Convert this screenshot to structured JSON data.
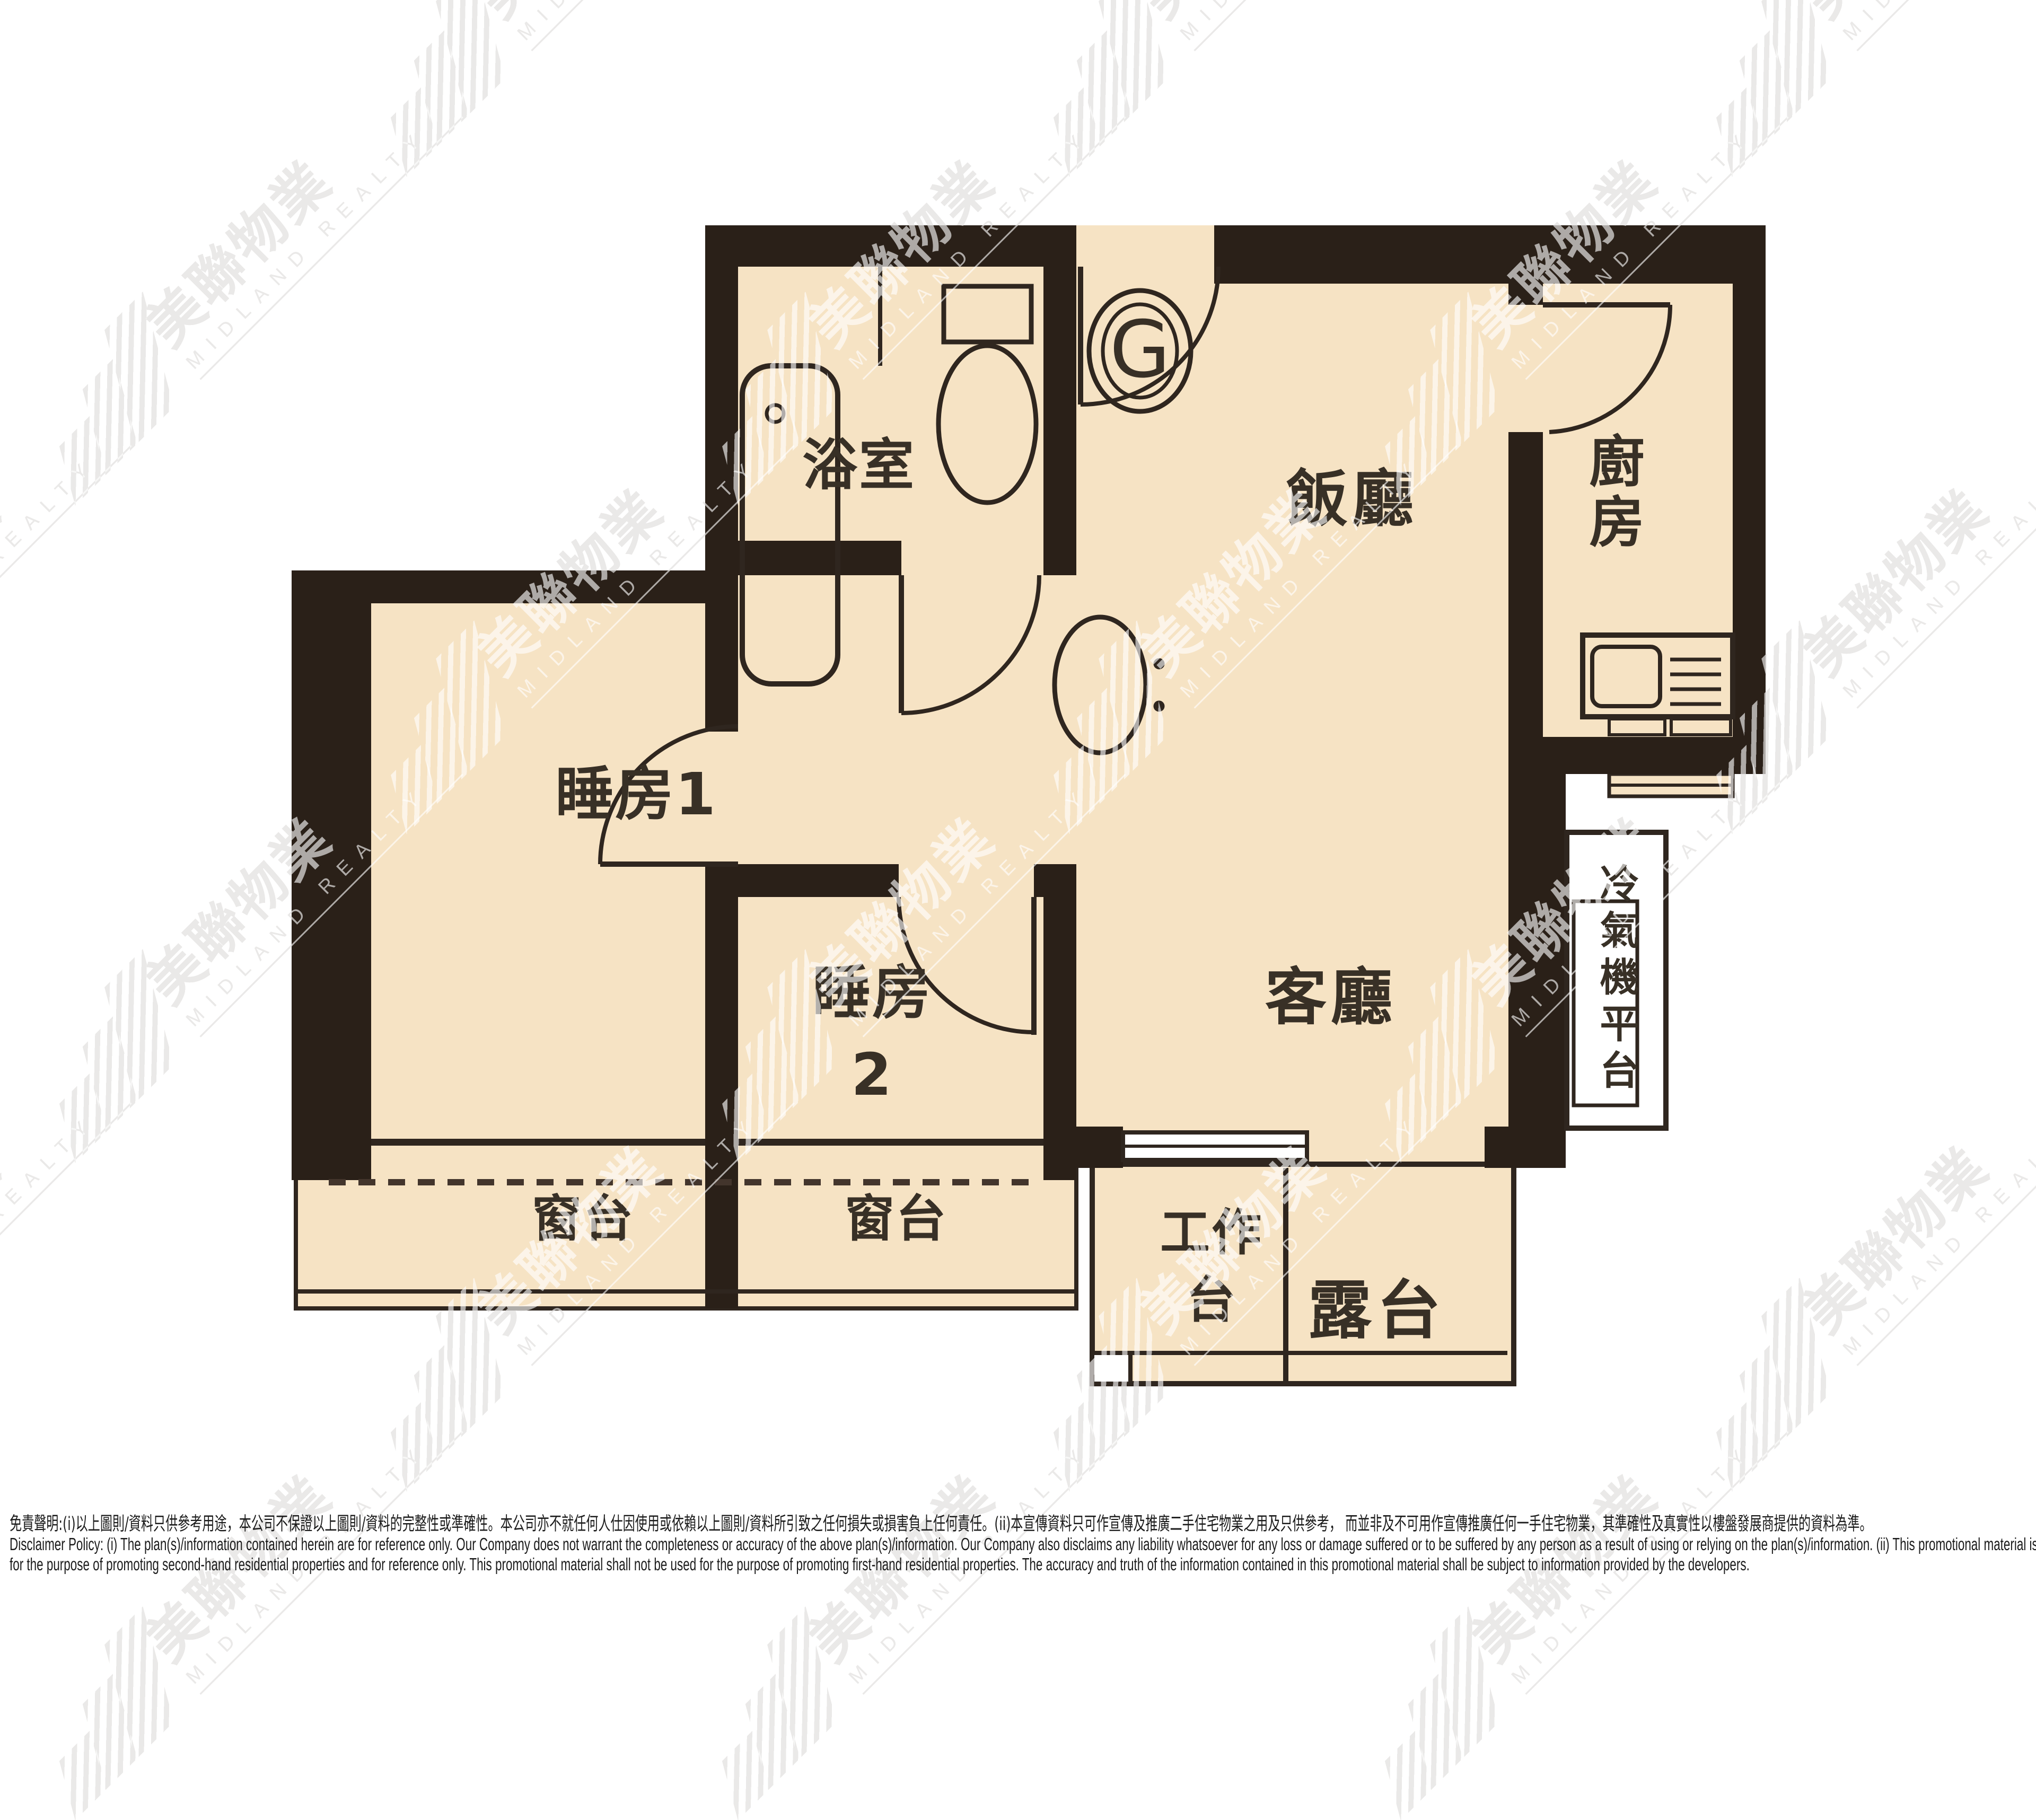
{
  "floorplan": {
    "unit_label": "G",
    "colors": {
      "wall": "#2a2018",
      "floor": "#f6e3c4",
      "line": "#2f261f",
      "watermark_gray": "#c9c5c2",
      "dash": "#43352c"
    },
    "labels": {
      "bathroom": "浴室",
      "dining": "飯廳",
      "kitchen": "廚房",
      "bedroom1": "睡房1",
      "bedroom2": "睡房\n2",
      "living": "客廳",
      "bay_window_left": "窗台",
      "bay_window_right": "窗台",
      "ac_platform": "冷氣機平台",
      "utility_platform": "工作\n台",
      "balcony": "露台"
    }
  },
  "watermark": {
    "name_zh": "美聯物業",
    "name_en": "MIDLAND REALTY"
  },
  "disclaimer": {
    "zh": "免責聲明:(i)以上圖則/資料只供參考用途，本公司不保證以上圖則/資料的完整性或準確性。本公司亦不就任何人仕因使用或依賴以上圖則/資料所引致之任何損失或損害負上任何責任。(ii)本宣傳資料只可作宣傳及推廣二手住宅物業之用及只供參考， 而並非及不可用作宣傳推廣任何一手住宅物業，其準確性及真實性以樓盤發展商提供的資料為準。",
    "en1": "Disclaimer Policy: (i) The plan(s)/information contained herein are for reference only. Our Company does not warrant the completeness or accuracy of the above plan(s)/information. Our Company also disclaims any liability whatsoever for any loss or damage suffered or to be suffered by any person as a result of using or relying on the plan(s)/information. (ii) This promotional material is",
    "en2": "for the purpose of promoting second-hand residential properties and for reference only. This promotional material shall not be used for the purpose of promoting first-hand residential properties. The accuracy and truth of the information contained in this promotional material shall be subject to information provided by the developers."
  }
}
